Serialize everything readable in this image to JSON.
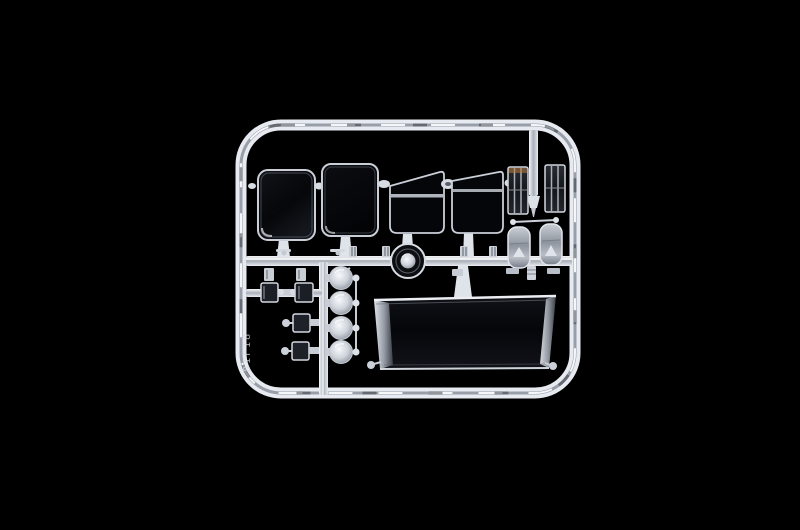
{
  "scene": {
    "description": "studio photo of a clear plastic model-kit sprue on black",
    "background_color": "#000000",
    "sprue_highlight_color": "#eef1f6",
    "sprue_mid_color": "#b9bfc9",
    "glass_tint_color": "#0a0c10",
    "warm_reflection_color": "#b97a3a",
    "embossed_code": "81F18"
  },
  "parts": {
    "frame": "outer-sprue-frame",
    "runners": [
      "main-horizontal-runner",
      "left-vertical-runner",
      "lower-sub-runner",
      "top-right-runner-stub"
    ],
    "windows": [
      {
        "id": "side-window-1",
        "shape": "rounded-rect"
      },
      {
        "id": "side-window-2",
        "shape": "rounded-rect"
      },
      {
        "id": "door-window-1",
        "shape": "trapezoid-with-divider"
      },
      {
        "id": "door-window-2",
        "shape": "trapezoid-with-divider"
      }
    ],
    "windshield": {
      "id": "windshield",
      "shape": "wide-trapezoid"
    },
    "headlight_lenses": {
      "count": 4,
      "shape": "round-dome"
    },
    "ribbed_lenses": {
      "count": 2,
      "shape": "slatted-rect"
    },
    "mirrors": {
      "count": 2,
      "shape": "rounded-rect"
    },
    "small_square_lenses": {
      "count": 4
    },
    "roof_light_lens": {
      "count": 1,
      "shape": "ring-with-dome"
    }
  }
}
